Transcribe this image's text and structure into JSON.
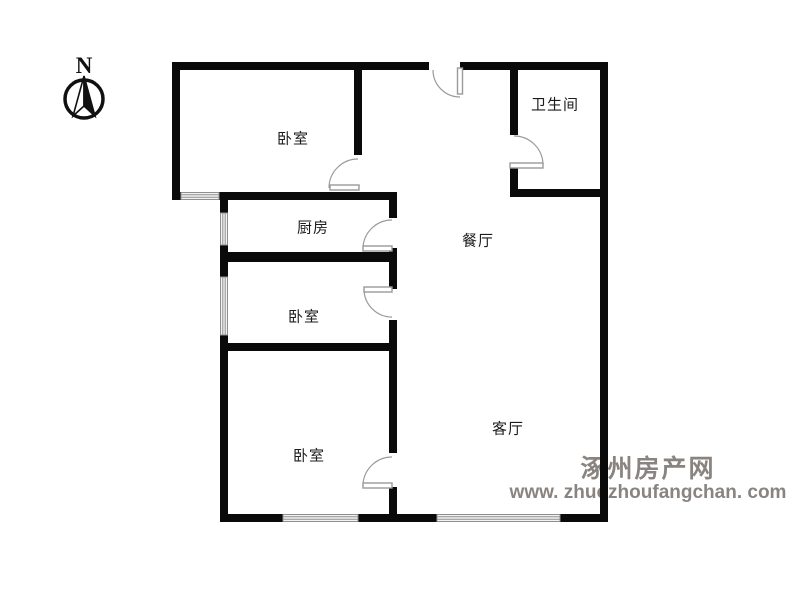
{
  "compass": {
    "north_label": "N"
  },
  "rooms": {
    "bedroom_top": {
      "label": "卧室"
    },
    "kitchen": {
      "label": "厨房"
    },
    "bedroom_middle": {
      "label": "卧室"
    },
    "bedroom_bottom": {
      "label": "卧室"
    },
    "bathroom": {
      "label": "卫生间"
    },
    "dining": {
      "label": "餐厅"
    },
    "living": {
      "label": "客厅"
    }
  },
  "watermark": {
    "site_name": "涿州房产网",
    "site_url": "www. zhuozhoufangchan. com"
  },
  "colors": {
    "wall": "#0a0a0a",
    "door_line": "#9a9a9a",
    "window_line": "#8f8f8f",
    "watermark_text": "#8a8480"
  }
}
